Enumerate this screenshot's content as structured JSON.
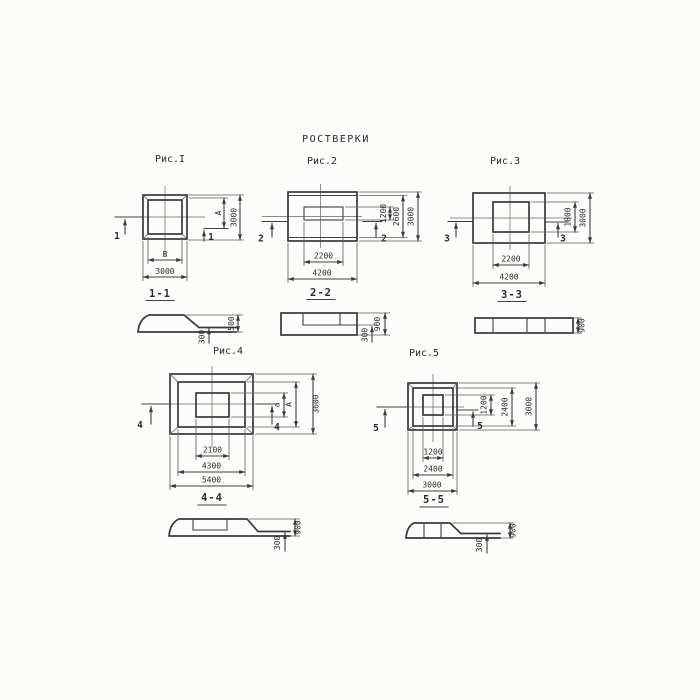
{
  "title": "РОСТВЕРКИ",
  "colors": {
    "line": "#3a3a3a",
    "text": "#2b2b2b",
    "background": "#fcfcfa"
  },
  "figures": {
    "fig1": {
      "caption": "Рис.I",
      "cut_number": "1",
      "section_title": "1-1",
      "plan_dims": {
        "inner_width": "В",
        "outer_width": "3000",
        "inner_height": "А",
        "outer_height": "3000"
      },
      "section_dims": {
        "total_height": "500",
        "edge_height": "300"
      }
    },
    "fig2": {
      "caption": "Рис.2",
      "cut_number": "2",
      "section_title": "2-2",
      "plan_dims": {
        "inner_width": "2200",
        "outer_width": "4200",
        "inner_height": "1200",
        "mid_height": "2600",
        "outer_height": "3000"
      },
      "section_dims": {
        "total_height": "900",
        "edge_height": "300"
      }
    },
    "fig3": {
      "caption": "Рис.3",
      "cut_number": "3",
      "section_title": "3-3",
      "plan_dims": {
        "inner_width": "2200",
        "outer_width": "4200",
        "inner_height": "1800",
        "outer_height": "3000"
      },
      "section_dims": {
        "total_height": "900"
      }
    },
    "fig4": {
      "caption": "Рис.4",
      "cut_number": "4",
      "section_title": "4-4",
      "plan_dims": {
        "inner_width": "2100",
        "mid_width": "4300",
        "outer_width": "5400",
        "inner_height": "а",
        "mid_height": "А",
        "outer_height": "3600"
      },
      "section_dims": {
        "total_height": "900",
        "edge_height": "300"
      }
    },
    "fig5": {
      "caption": "Рис.5",
      "cut_number": "5",
      "section_title": "5-5",
      "plan_dims": {
        "inner_width": "1200",
        "mid_width": "2400",
        "outer_width": "3000",
        "inner_height": "1200",
        "mid_height": "2400",
        "outer_height": "3000"
      },
      "section_dims": {
        "total_height": "900",
        "edge_height": "300"
      }
    }
  }
}
